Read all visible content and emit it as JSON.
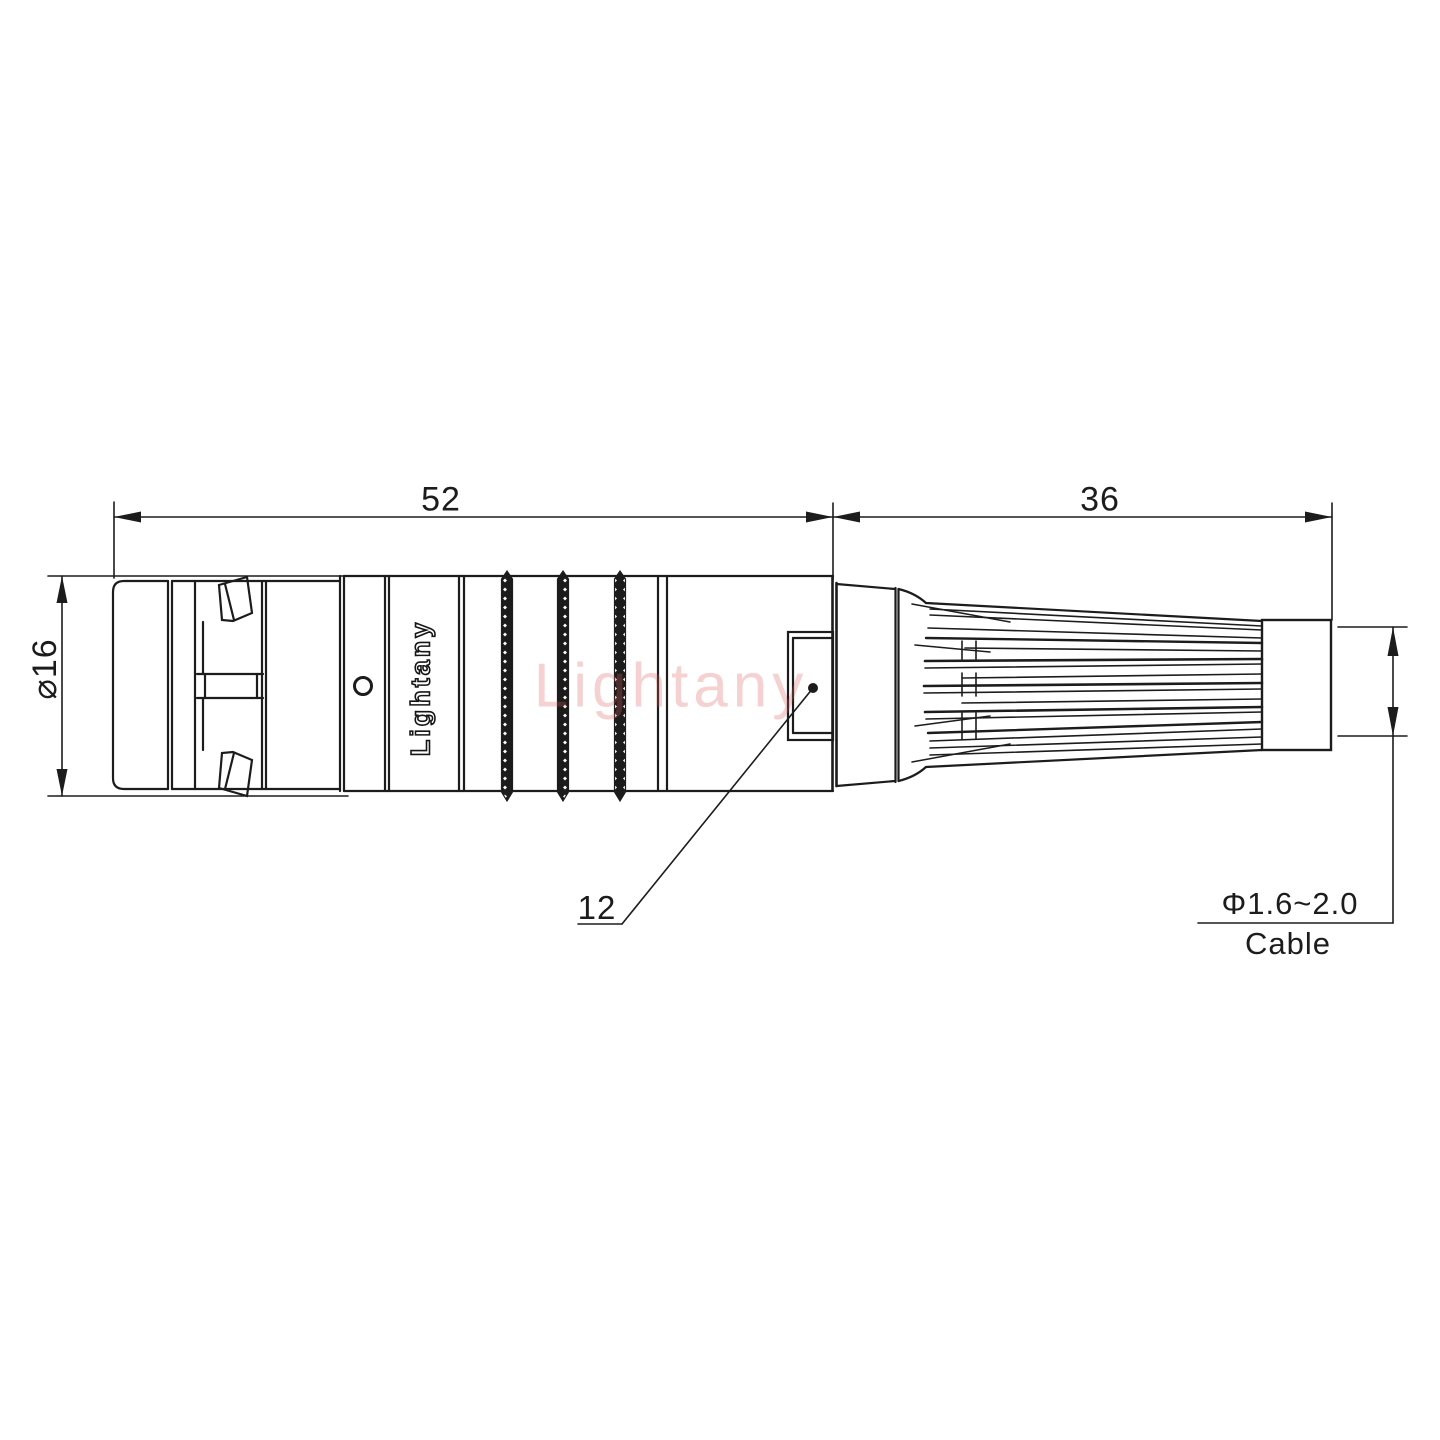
{
  "drawing": {
    "title_hint": "connector outline drawing",
    "dims": {
      "front_length": "52",
      "rear_length": "36",
      "diameter": "⌀16",
      "latch_width": "12",
      "cable_range": "Φ1.6~2.0",
      "cable_word": "Cable"
    },
    "branding": {
      "body_engraving": "Lightany",
      "watermark": "Lightany"
    },
    "colors": {
      "line": "#1c1c1c",
      "watermark_pink": "#dd5858",
      "background": "#ffffff"
    }
  }
}
